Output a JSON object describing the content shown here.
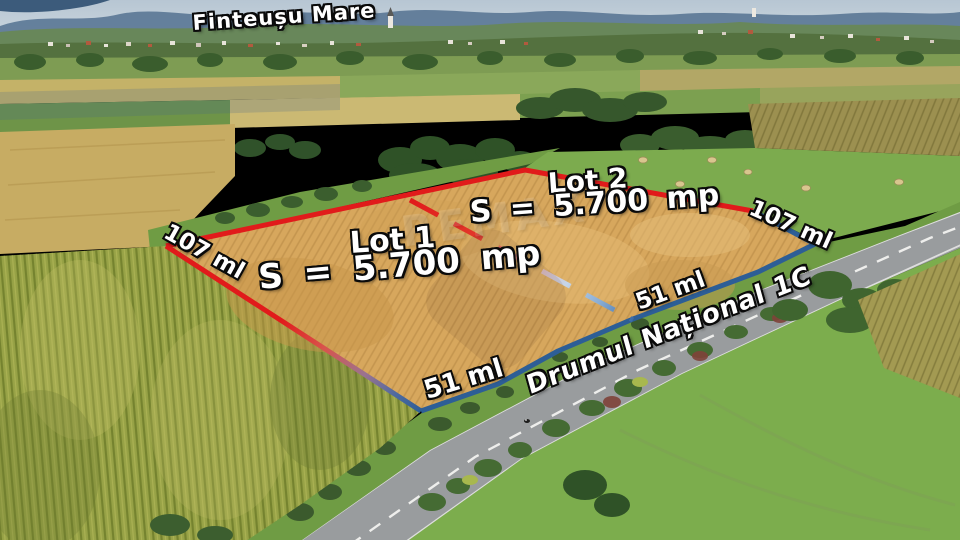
{
  "photo": {
    "place_label": "Finteușu Mare",
    "road_label": "Drumul Național 1C",
    "watermark_text": "REMAX"
  },
  "lots": [
    {
      "name": "Lot 1",
      "area": "S = 5.700 mp",
      "front_length": "51 ml",
      "side_length": "107 ml"
    },
    {
      "name": "Lot 2",
      "area": "S = 5.700 mp",
      "front_length": "51 ml",
      "side_length": "107 ml"
    }
  ],
  "colors": {
    "rear_boundary": "#e11b1b",
    "front_boundary": "#2d5e96",
    "divider_light": "#a9c9e9"
  }
}
